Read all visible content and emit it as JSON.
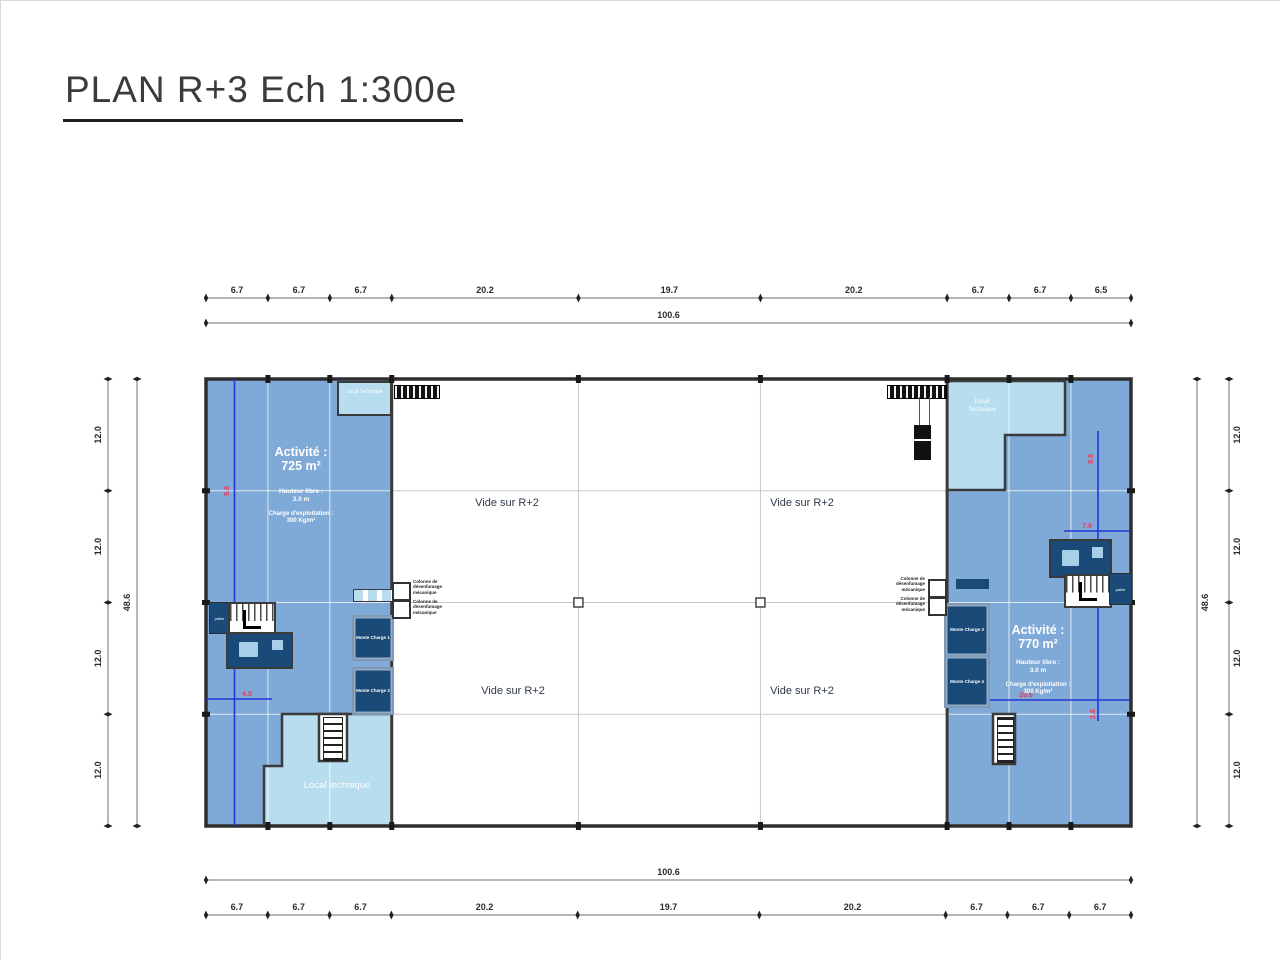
{
  "title": "PLAN R+3 Ech 1:300e",
  "dimensions": {
    "top_segments": [
      "6.7",
      "6.7",
      "6.7",
      "20.2",
      "19.7",
      "20.2",
      "6.7",
      "6.7",
      "6.5"
    ],
    "top_total": "100.6",
    "bottom_segments": [
      "6.7",
      "6.7",
      "6.7",
      "20.2",
      "19.7",
      "20.2",
      "6.7",
      "6.7",
      "6.7"
    ],
    "bottom_total": "100.6",
    "left_segments": [
      "12.0",
      "12.0",
      "12.0",
      "12.0"
    ],
    "left_total": "48.6",
    "right_segments": [
      "12.0",
      "12.0",
      "12.0",
      "12.0"
    ],
    "right_total": "48.6"
  },
  "zones": {
    "left_activity": {
      "name": "Activité :",
      "area": "725 m²",
      "clear_height_label": "Hauteur libre :",
      "clear_height": "3.0 m",
      "load_label": "Charge d'exploitation :",
      "load": "300 Kg/m²"
    },
    "right_activity": {
      "name": "Activité :",
      "area": "770 m²",
      "clear_height_label": "Hauteur libre :",
      "clear_height": "3.0 m",
      "load_label": "Charge d'exploitation :",
      "load": "300 Kg/m²"
    },
    "void_top_left": "Vide sur R+2",
    "void_top_right": "Vide sur R+2",
    "void_bottom_left": "Vide sur R+2",
    "void_bottom_right": "Vide sur R+2",
    "local_technique_top_left": "Local Technique",
    "local_technique_top_right": "Local Technique",
    "local_technique_bottom_left": "Local technique"
  },
  "rooms": {
    "monte_charge_1": "Monte Charge 1",
    "monte_charge_2": "Monte Charge 2",
    "monte_charge_3": "Monte Charge 3",
    "monte_charge_4": "Monte Charge 4",
    "palier_left": "palier",
    "palier_right": "palier",
    "smoke_column_label": "Colonne de désenfumage mécanique"
  },
  "red_annotations": {
    "left_vertical": "9.8",
    "left_horizontal": "4.0",
    "right_vertical_top": "9.8",
    "right_horizontal_top": "7.6",
    "right_horizontal_bottom": "26.6",
    "right_vertical_bottom": "2.6"
  },
  "colors": {
    "zone_blue": "#7FA9D6",
    "zone_light_blue": "#B7DDEE",
    "room_navy": "#1A4A78",
    "annotation_blue": "#2337D7",
    "annotation_red": "#EB3C5A",
    "wall": "#3A3A3A",
    "dim_line": "#8A8A8A",
    "grid": "#C9C9C9"
  }
}
